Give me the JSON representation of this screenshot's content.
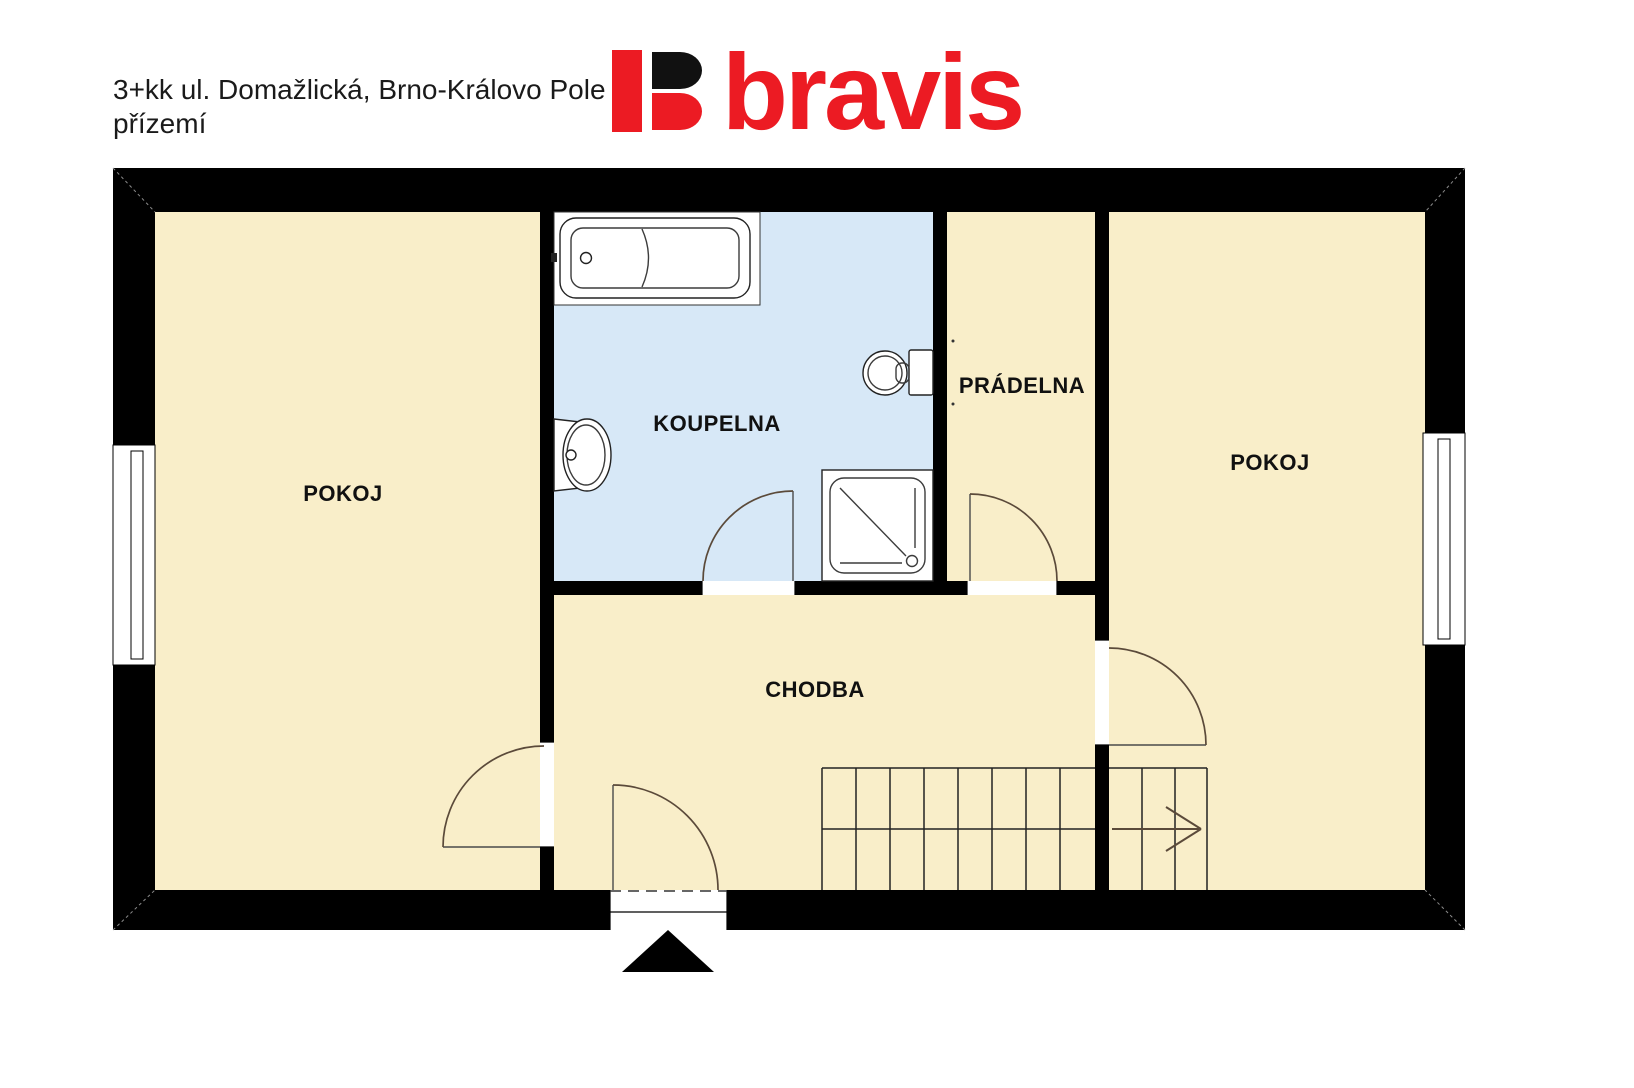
{
  "title": {
    "line1": "3+kk ul. Domažlická, Brno-Královo Pole",
    "line2": "přízemí"
  },
  "logo": {
    "wordmark": "bravis"
  },
  "rooms": {
    "pokoj_left": "POKOJ",
    "koupelna": "KOUPELNA",
    "pradelna": "PRÁDELNA",
    "pokoj_right": "POKOJ",
    "chodba": "CHODBA"
  },
  "fixtures": {
    "bathtub": "bathtub",
    "sink": "sink",
    "toilet": "toilet",
    "shower": "shower",
    "stairs": "stairs",
    "entrance_marker": "entrance-triangle"
  },
  "colors": {
    "room_fill": "#F9EEC9",
    "bath_fill": "#D7E8F7",
    "wall": "#000000",
    "logo_red": "#EC1B23",
    "logo_black": "#111111"
  }
}
